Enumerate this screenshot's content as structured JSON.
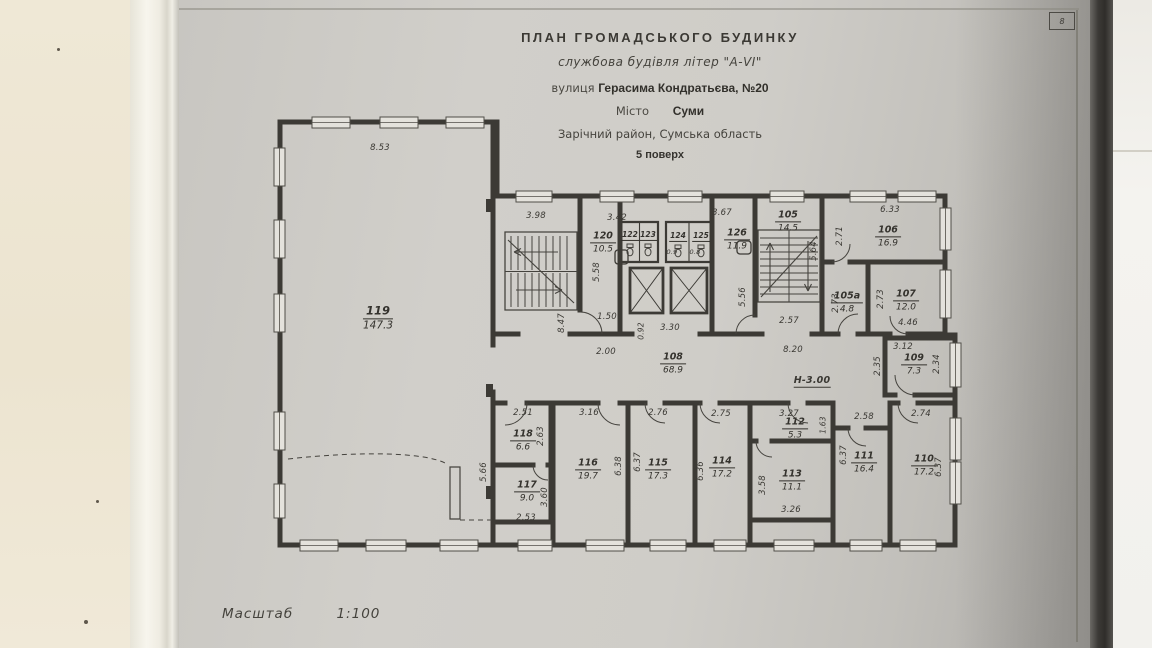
{
  "colors": {
    "document_paper": "#cdcbc6",
    "desk_surface": "#ede5d1",
    "ink": "#3b3934",
    "page_edge_shadow": "#2f2d2a"
  },
  "title_block": {
    "title": "ПЛАН ГРОМАДСЬКОГО БУДИНКУ",
    "subtitle": "службова будівля літер \"А-VI\"",
    "street_label": "вулиця",
    "street_value": "Герасима Кондратьєва, №20",
    "city_label": "Місто",
    "city_value": "Суми",
    "district_line": "Зарічний район, Сумська область",
    "floor_line": "5 поверх"
  },
  "page_marker": "8",
  "footer": {
    "scale_label": "Масштаб",
    "scale_value": "1:100"
  },
  "plan": {
    "height_note": "Н-3.00",
    "rooms": [
      {
        "num": "119",
        "area": "147.3",
        "x": 378,
        "y": 318,
        "size": "lg"
      },
      {
        "num": "120",
        "area": "10.5",
        "x": 603,
        "y": 243
      },
      {
        "num": "122",
        "x": 630,
        "y": 236,
        "size": "sm"
      },
      {
        "num": "123",
        "x": 648,
        "y": 236,
        "size": "sm"
      },
      {
        "num": "124",
        "x": 678,
        "y": 237,
        "size": "sm"
      },
      {
        "num": "125",
        "x": 701,
        "y": 237,
        "size": "sm"
      },
      {
        "num": "126",
        "area": "11.9",
        "x": 737,
        "y": 240
      },
      {
        "num": "105",
        "area": "14.5",
        "x": 788,
        "y": 222
      },
      {
        "num": "106",
        "area": "16.9",
        "x": 888,
        "y": 237
      },
      {
        "num": "105а",
        "area": "4.8",
        "x": 847,
        "y": 303
      },
      {
        "num": "107",
        "area": "12.0",
        "x": 906,
        "y": 301
      },
      {
        "num": "108",
        "area": "68.9",
        "x": 673,
        "y": 364
      },
      {
        "num": "109",
        "area": "7.3",
        "x": 914,
        "y": 365
      },
      {
        "num": "118",
        "area": "6.6",
        "x": 523,
        "y": 441
      },
      {
        "num": "117",
        "area": "9.0",
        "x": 527,
        "y": 492
      },
      {
        "num": "116",
        "area": "19.7",
        "x": 588,
        "y": 470
      },
      {
        "num": "115",
        "area": "17.3",
        "x": 658,
        "y": 470
      },
      {
        "num": "114",
        "area": "17.2",
        "x": 722,
        "y": 468
      },
      {
        "num": "112",
        "area": "5.3",
        "x": 795,
        "y": 429
      },
      {
        "num": "113",
        "area": "11.1",
        "x": 792,
        "y": 481
      },
      {
        "num": "111",
        "area": "16.4",
        "x": 864,
        "y": 463
      },
      {
        "num": "110",
        "area": "17.2",
        "x": 924,
        "y": 466
      }
    ],
    "dims": [
      {
        "t": "8.53",
        "x": 380,
        "y": 148
      },
      {
        "t": "3.98",
        "x": 536,
        "y": 216
      },
      {
        "t": "8.47",
        "x": 562,
        "y": 323,
        "r": -90
      },
      {
        "t": "3.42",
        "x": 617,
        "y": 218
      },
      {
        "t": "5.58",
        "x": 597,
        "y": 272,
        "r": -90
      },
      {
        "t": "1.50",
        "x": 607,
        "y": 317
      },
      {
        "t": "0.92",
        "x": 641,
        "y": 331,
        "r": -90,
        "s": 7.5
      },
      {
        "t": "3.30",
        "x": 670,
        "y": 328
      },
      {
        "t": "3.67",
        "x": 722,
        "y": 213
      },
      {
        "t": "5.56",
        "x": 743,
        "y": 297,
        "r": -90
      },
      {
        "t": "2.00",
        "x": 606,
        "y": 352
      },
      {
        "t": "0.9",
        "x": 672,
        "y": 252,
        "s": 6.5
      },
      {
        "t": "0.8",
        "x": 695,
        "y": 252,
        "s": 6.5
      },
      {
        "t": "2.57",
        "x": 789,
        "y": 321
      },
      {
        "t": "5.64",
        "x": 814,
        "y": 251,
        "r": -90
      },
      {
        "t": "6.33",
        "x": 890,
        "y": 210
      },
      {
        "t": "2.71",
        "x": 840,
        "y": 236,
        "r": -90
      },
      {
        "t": "2.73",
        "x": 836,
        "y": 303,
        "r": -90
      },
      {
        "t": "2.73",
        "x": 881,
        "y": 299,
        "r": -90
      },
      {
        "t": "4.46",
        "x": 908,
        "y": 323
      },
      {
        "t": "8.20",
        "x": 793,
        "y": 350
      },
      {
        "t": "Н-3.00",
        "x": 812,
        "y": 381,
        "u": true,
        "s": 9.5
      },
      {
        "t": "2.35",
        "x": 878,
        "y": 366,
        "r": -90
      },
      {
        "t": "3.12",
        "x": 903,
        "y": 347
      },
      {
        "t": "2.34",
        "x": 937,
        "y": 364,
        "r": -90
      },
      {
        "t": "2.51",
        "x": 523,
        "y": 413
      },
      {
        "t": "2.63",
        "x": 541,
        "y": 436,
        "r": -90
      },
      {
        "t": "5.66",
        "x": 484,
        "y": 472,
        "r": -90
      },
      {
        "t": "3.60",
        "x": 545,
        "y": 497,
        "r": -90
      },
      {
        "t": "2.53",
        "x": 526,
        "y": 518
      },
      {
        "t": "3.16",
        "x": 589,
        "y": 413
      },
      {
        "t": "6.38",
        "x": 619,
        "y": 466,
        "r": -90
      },
      {
        "t": "6.37",
        "x": 638,
        "y": 462,
        "r": -90
      },
      {
        "t": "2.76",
        "x": 658,
        "y": 413
      },
      {
        "t": "6.36",
        "x": 701,
        "y": 471,
        "r": -90
      },
      {
        "t": "2.75",
        "x": 721,
        "y": 414
      },
      {
        "t": "3.27",
        "x": 789,
        "y": 414
      },
      {
        "t": "1.63",
        "x": 823,
        "y": 425,
        "r": -90,
        "s": 7.5
      },
      {
        "t": "3.58",
        "x": 763,
        "y": 485,
        "r": -90
      },
      {
        "t": "3.26",
        "x": 791,
        "y": 510
      },
      {
        "t": "2.58",
        "x": 864,
        "y": 417
      },
      {
        "t": "6.37",
        "x": 844,
        "y": 455,
        "r": -90
      },
      {
        "t": "2.74",
        "x": 921,
        "y": 414
      },
      {
        "t": "6.37",
        "x": 939,
        "y": 467,
        "r": -90
      }
    ]
  }
}
